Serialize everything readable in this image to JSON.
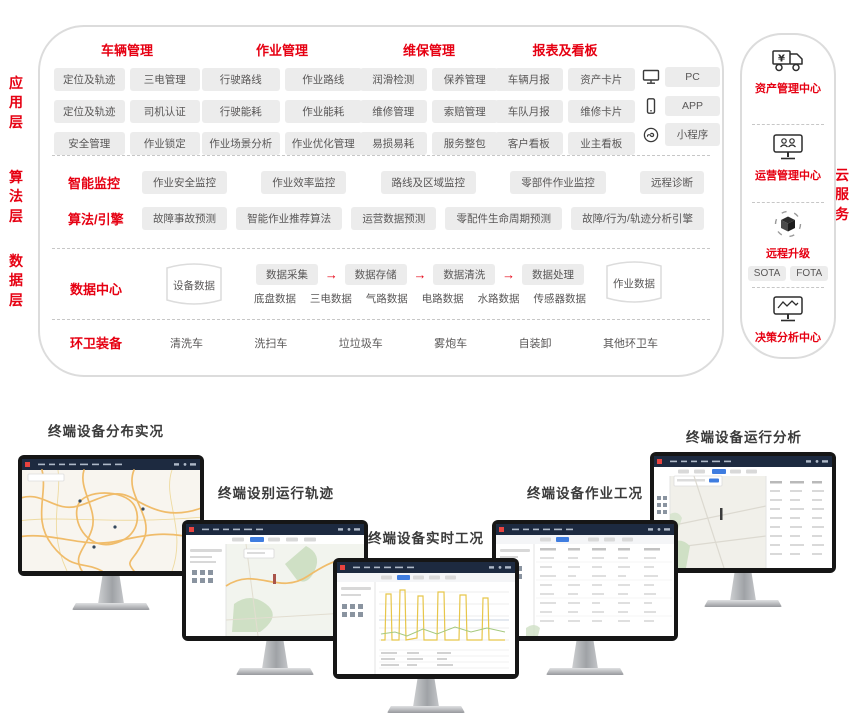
{
  "colors": {
    "accent": "#e60012",
    "chip_bg": "#ececec",
    "navy_header": "#1d2a40"
  },
  "layer_labels": {
    "app": "应用层",
    "algorithm": "算法层",
    "data": "数据层",
    "cloud": "云服务"
  },
  "app_layer": {
    "groups": [
      {
        "title": "车辆管理",
        "chips": [
          "定位及轨迹",
          "三电管理",
          "定位及轨迹",
          "司机认证",
          "安全管理",
          "作业锁定"
        ]
      },
      {
        "title": "作业管理",
        "chips": [
          "行驶路线",
          "作业路线",
          "行驶能耗",
          "作业能耗",
          "作业场景分析",
          "作业优化管理"
        ]
      },
      {
        "title": "维保管理",
        "chips": [
          "润滑检测",
          "保养管理",
          "维修管理",
          "索赔管理",
          "易损易耗",
          "服务整包"
        ]
      },
      {
        "title": "报表及看板",
        "chips": [
          "车辆月报",
          "资产卡片",
          "车队月报",
          "维修卡片",
          "客户看板",
          "业主看板"
        ]
      }
    ],
    "platforms": [
      {
        "icon": "pc-icon",
        "label": "PC"
      },
      {
        "icon": "phone-icon",
        "label": "APP"
      },
      {
        "icon": "miniprogram-icon",
        "label": "小程序"
      }
    ]
  },
  "algorithm_layer": {
    "rows": [
      {
        "title": "智能监控",
        "chips": [
          "作业安全监控",
          "作业效率监控",
          "路线及区域监控",
          "零部件作业监控",
          "远程诊断"
        ]
      },
      {
        "title": "算法/引擎",
        "chips": [
          "故障事故预测",
          "智能作业推荐算法",
          "运营数据预测",
          "零配件生命周期预测",
          "故障/行为/轨迹分析引擎"
        ]
      }
    ]
  },
  "data_layer": {
    "title": "数据中心",
    "device_store": "设备数据",
    "work_store": "作业数据",
    "pipeline": [
      "数据采集",
      "数据存储",
      "数据清洗",
      "数据处理"
    ],
    "arrow": "→",
    "data_types": [
      "底盘数据",
      "三电数据",
      "气路数据",
      "电路数据",
      "水路数据",
      "传感器数据"
    ]
  },
  "equipment": {
    "title": "环卫装备",
    "items": [
      "清洗车",
      "洗扫车",
      "垃垃圾车",
      "雾炮车",
      "自装卸",
      "其他环卫车"
    ]
  },
  "cloud_services": {
    "sections": [
      {
        "icon": "truck-yen-icon",
        "title": "资产管理中心"
      },
      {
        "icon": "monitor-users-icon",
        "title": "运营管理中心"
      },
      {
        "icon": "ota-cube-icon",
        "title": "远程升级",
        "chips": [
          "SOTA",
          "FOTA"
        ]
      },
      {
        "icon": "monitor-chart-icon",
        "title": "决策分析中心"
      }
    ]
  },
  "monitors": [
    {
      "label": "终端设备分布实况"
    },
    {
      "label": "终端设别运行轨迹"
    },
    {
      "label": "终端设备实时工况"
    },
    {
      "label": "终端设备作业工况"
    },
    {
      "label": "终端设备运行分析"
    }
  ]
}
